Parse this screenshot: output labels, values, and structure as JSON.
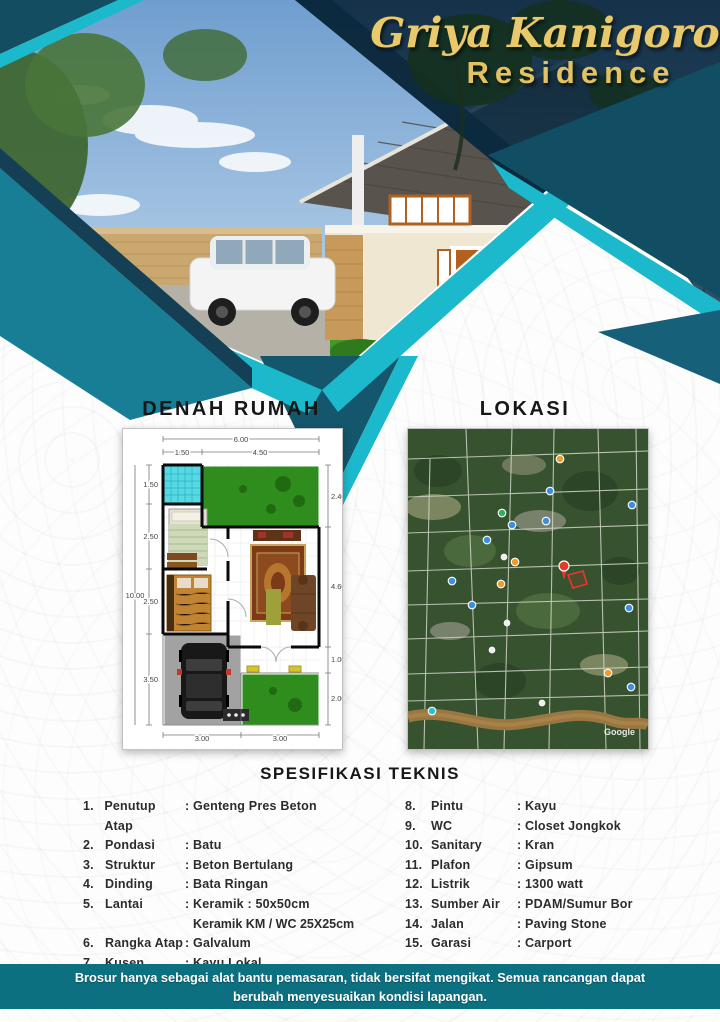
{
  "brand": {
    "title_script": "Griya Kanigoro",
    "title_sub": "Residence"
  },
  "headings": {
    "floorplan": "DENAH RUMAH",
    "location": "LOKASI",
    "specs": "SPESIFIKASI TEKNIS"
  },
  "floorplan": {
    "dims": {
      "top_total": "6.00",
      "top_left_seg": "1.50",
      "top_right_seg": "4.50",
      "left_total": "10.00",
      "left_seg1": "1.50",
      "left_seg2": "2.50",
      "left_seg3": "2.50",
      "left_seg4": "3.50",
      "right_seg1": "2.40",
      "right_seg2": "4.60",
      "right_seg3": "1.00",
      "right_seg4": "2.00",
      "bottom_seg1": "3.00",
      "bottom_seg2": "3.00"
    }
  },
  "map": {
    "watermark": "Google"
  },
  "specs": {
    "left": [
      {
        "no": "1.",
        "label": "Penutup Atap",
        "value": ": Genteng Pres Beton"
      },
      {
        "no": "2.",
        "label": "Pondasi",
        "value": ": Batu"
      },
      {
        "no": "3.",
        "label": "Struktur",
        "value": ": Beton Bertulang"
      },
      {
        "no": "4.",
        "label": "Dinding",
        "value": ": Bata Ringan"
      },
      {
        "no": "5.",
        "label": "Lantai",
        "value": ": Keramik : 50x50cm",
        "value2": "Keramik KM / WC 25X25cm"
      },
      {
        "no": "6.",
        "label": "Rangka Atap",
        "value": ": Galvalum"
      },
      {
        "no": "7.",
        "label": "Kusen",
        "value": ": Kayu Lokal"
      }
    ],
    "right": [
      {
        "no": "8.",
        "label": "Pintu",
        "value": ": Kayu"
      },
      {
        "no": "9.",
        "label": "WC",
        "value": ": Closet Jongkok"
      },
      {
        "no": "10.",
        "label": "Sanitary",
        "value": ": Kran"
      },
      {
        "no": "11.",
        "label": "Plafon",
        "value": ": Gipsum"
      },
      {
        "no": "12.",
        "label": "Listrik",
        "value": ": 1300 watt"
      },
      {
        "no": "13.",
        "label": "Sumber Air",
        "value": ": PDAM/Sumur Bor"
      },
      {
        "no": "14.",
        "label": "Jalan",
        "value": ": Paving Stone"
      },
      {
        "no": "15.",
        "label": "Garasi",
        "value": ": Carport"
      }
    ]
  },
  "footer": {
    "text": "Brosur hanya sebagai alat bantu pemasaran, tidak bersifat mengikat. Semua rancangan dapat berubah menyesuaikan kondisi lapangan."
  },
  "colors": {
    "teal_main": "#187E95",
    "teal_dark": "#134D62",
    "cyan_accent": "#1CB9CC",
    "navy_night": "#0C2A3E",
    "gold_title": "#E8C96B",
    "footer_band": "#0D7080"
  }
}
